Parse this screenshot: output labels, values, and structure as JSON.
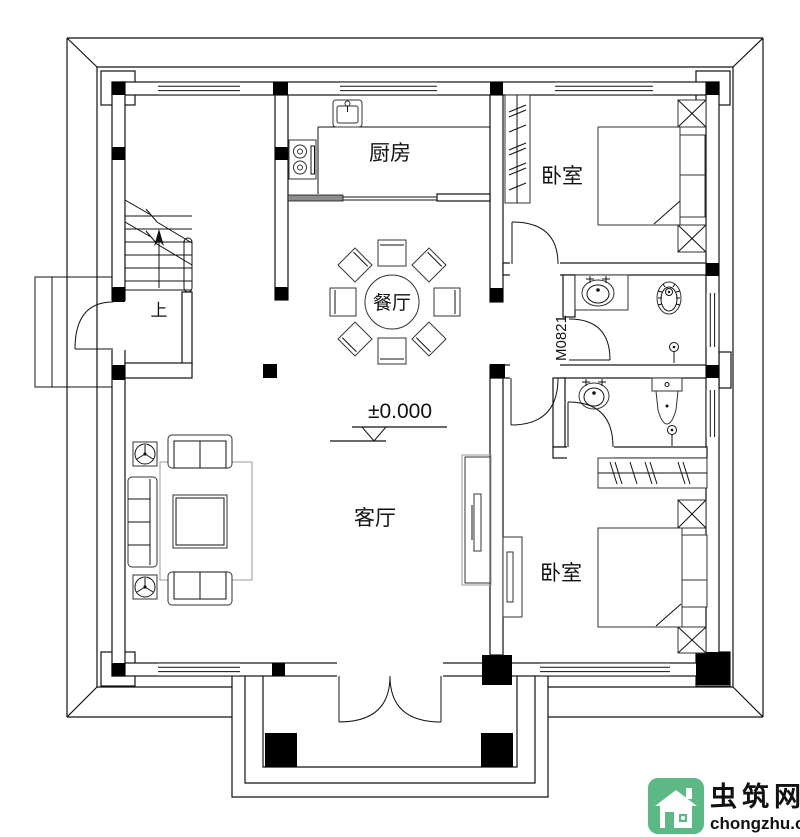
{
  "floorplan": {
    "labels": {
      "kitchen": "厨房",
      "dining": "餐厅",
      "living": "客厅",
      "bedroom_top_right": "卧室",
      "bedroom_bottom_right": "卧室",
      "stairs_up": "上",
      "elevation": "±0.000",
      "door_code": "M0821"
    },
    "colors": {
      "line": "#111111",
      "sliding_door_fill": "#8c8c8c"
    }
  },
  "watermark": {
    "site_name": "虫筑网",
    "site_url": "chongzhu.cn",
    "colors": {
      "brand_green": "#5cb885",
      "name_dark": "#493f33"
    }
  }
}
